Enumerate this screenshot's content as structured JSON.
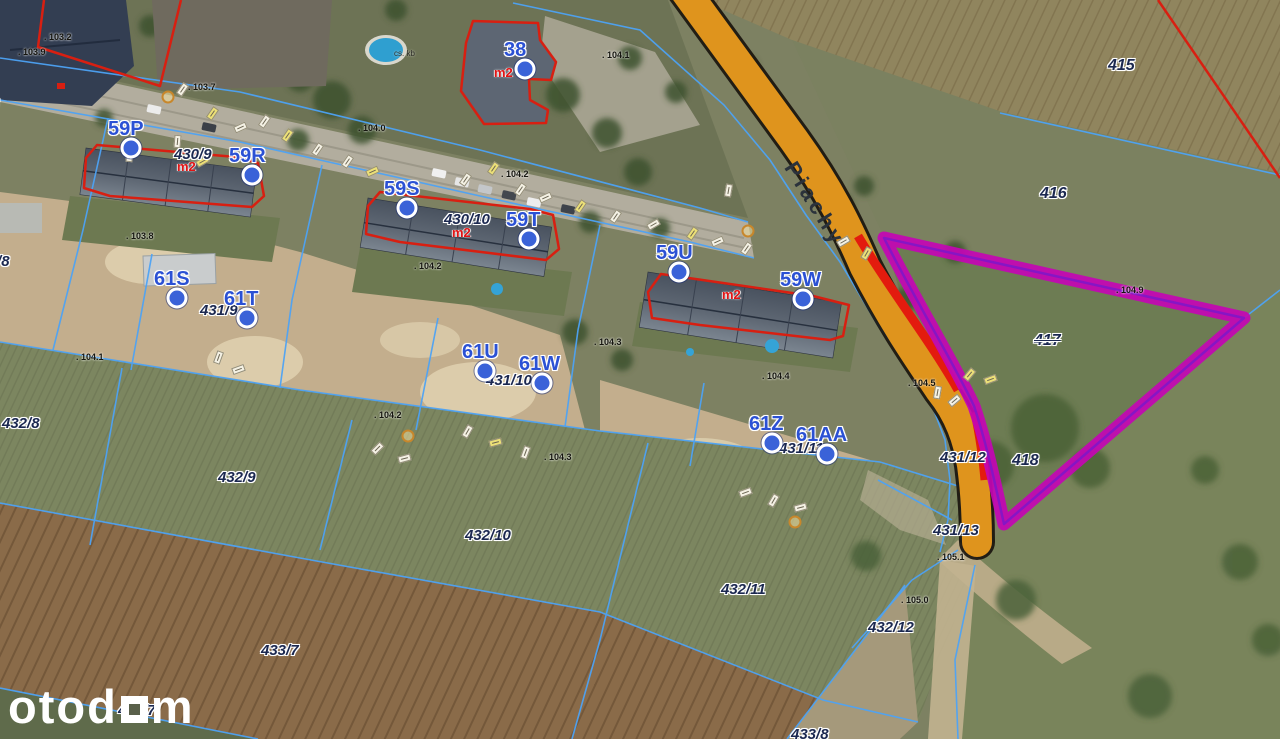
{
  "map": {
    "street": {
      "text": "Piachy",
      "x": 799,
      "y": 158,
      "rot": 58
    },
    "watermark": {
      "prefix": "otod",
      "suffix": "m"
    },
    "tiny_label": {
      "text": "cs. kb",
      "x": 394,
      "y": 50
    },
    "colors": {
      "road": "#df941d",
      "road_red_stripe": "#e31b0e",
      "highlight": "#c405b4",
      "highlight_inner": "#7d18c9",
      "cadastral_line": "#4da3f5",
      "building_outline": "#d81f11",
      "marker_fill": "#3a62d8",
      "marker_text": "#2b51d4",
      "parcel_text": "#1b2850",
      "area_text": "#e21414"
    },
    "parcel_labels": [
      {
        "text": "415",
        "x": 1108,
        "y": 58,
        "big": true
      },
      {
        "text": "416",
        "x": 1040,
        "y": 186,
        "big": true
      },
      {
        "text": "417",
        "x": 1034,
        "y": 333,
        "big": true,
        "struck": true
      },
      {
        "text": "418",
        "x": 1012,
        "y": 453,
        "big": true
      },
      {
        "text": "430/8",
        "x": -38,
        "y": 96
      },
      {
        "text": "430/9",
        "x": 174,
        "y": 147
      },
      {
        "text": "430/10",
        "x": 444,
        "y": 212
      },
      {
        "text": "431/8",
        "x": -28,
        "y": 254
      },
      {
        "text": "431/9",
        "x": 200,
        "y": 303
      },
      {
        "text": "431/10",
        "x": 486,
        "y": 373
      },
      {
        "text": "431/11",
        "x": 779,
        "y": 441
      },
      {
        "text": "431/12",
        "x": 940,
        "y": 450
      },
      {
        "text": "431/13",
        "x": 933,
        "y": 523
      },
      {
        "text": "432/8",
        "x": 2,
        "y": 416
      },
      {
        "text": "432/9",
        "x": 218,
        "y": 470
      },
      {
        "text": "432/10",
        "x": 465,
        "y": 528
      },
      {
        "text": "432/11",
        "x": 721,
        "y": 582
      },
      {
        "text": "432/12",
        "x": 868,
        "y": 620
      },
      {
        "text": "433/7",
        "x": 261,
        "y": 643
      },
      {
        "text": "433/8",
        "x": 791,
        "y": 727
      },
      {
        "text": "434/7",
        "x": 118,
        "y": 703
      }
    ],
    "address_markers": [
      {
        "text": "38",
        "cx": 525,
        "cy": 69,
        "lx": 504,
        "ly": 40
      },
      {
        "text": "59P",
        "cx": 131,
        "cy": 148,
        "lx": 108,
        "ly": 119
      },
      {
        "text": "59R",
        "cx": 252,
        "cy": 175,
        "lx": 229,
        "ly": 146
      },
      {
        "text": "59S",
        "cx": 407,
        "cy": 208,
        "lx": 384,
        "ly": 179
      },
      {
        "text": "59T",
        "cx": 529,
        "cy": 239,
        "lx": 506,
        "ly": 210
      },
      {
        "text": "59U",
        "cx": 679,
        "cy": 272,
        "lx": 656,
        "ly": 243
      },
      {
        "text": "59W",
        "cx": 803,
        "cy": 299,
        "lx": 780,
        "ly": 270
      },
      {
        "text": "61S",
        "cx": 177,
        "cy": 298,
        "lx": 154,
        "ly": 269
      },
      {
        "text": "61T",
        "cx": 247,
        "cy": 318,
        "lx": 224,
        "ly": 289
      },
      {
        "text": "61U",
        "cx": 485,
        "cy": 371,
        "lx": 462,
        "ly": 342
      },
      {
        "text": "61W",
        "cx": 542,
        "cy": 383,
        "lx": 519,
        "ly": 354
      },
      {
        "text": "61Z",
        "cx": 772,
        "cy": 443,
        "lx": 749,
        "ly": 414
      },
      {
        "text": "61AA",
        "cx": 827,
        "cy": 454,
        "lx": 796,
        "ly": 425
      }
    ],
    "area_labels": [
      {
        "text": "m2",
        "x": 494,
        "y": 66
      },
      {
        "text": "m2",
        "x": 177,
        "y": 160
      },
      {
        "text": "m2",
        "x": 452,
        "y": 226
      },
      {
        "text": "m2",
        "x": 722,
        "y": 288
      }
    ],
    "elevation_labels": [
      {
        "text": ". 103.2",
        "x": 44,
        "y": 33
      },
      {
        "text": ". 103.9",
        "x": 18,
        "y": 48
      },
      {
        "text": ". 103.7",
        "x": 188,
        "y": 83
      },
      {
        "text": ". 104.0",
        "x": 358,
        "y": 124
      },
      {
        "text": ". 104.1",
        "x": 602,
        "y": 51
      },
      {
        "text": ". 104.2",
        "x": 501,
        "y": 170
      },
      {
        "text": ". 103.8",
        "x": 126,
        "y": 232
      },
      {
        "text": ". 104.2",
        "x": 414,
        "y": 262
      },
      {
        "text": ". 104.1",
        "x": 76,
        "y": 353
      },
      {
        "text": ". 104.3",
        "x": 594,
        "y": 338
      },
      {
        "text": ". 104.2",
        "x": 374,
        "y": 411
      },
      {
        "text": ". 104.3",
        "x": 544,
        "y": 453
      },
      {
        "text": ". 104.4",
        "x": 762,
        "y": 372
      },
      {
        "text": ". 104.5",
        "x": 908,
        "y": 379
      },
      {
        "text": ". 104.9",
        "x": 1116,
        "y": 286
      },
      {
        "text": ". 105.1",
        "x": 937,
        "y": 553
      },
      {
        "text": ". 105.0",
        "x": 901,
        "y": 596
      }
    ],
    "survey_marks": [
      {
        "x": 176,
        "y": 86,
        "r": -55,
        "c": "w"
      },
      {
        "x": 206,
        "y": 110,
        "r": -55,
        "c": "y"
      },
      {
        "x": 234,
        "y": 124,
        "r": -25,
        "c": "w"
      },
      {
        "x": 258,
        "y": 118,
        "r": -55,
        "c": "w"
      },
      {
        "x": 281,
        "y": 132,
        "r": -55,
        "c": "y"
      },
      {
        "x": 171,
        "y": 138,
        "r": -85,
        "c": "w"
      },
      {
        "x": 123,
        "y": 152,
        "r": -85,
        "c": "w"
      },
      {
        "x": 196,
        "y": 158,
        "r": -30,
        "c": "y"
      },
      {
        "x": 311,
        "y": 146,
        "r": -55,
        "c": "w"
      },
      {
        "x": 341,
        "y": 158,
        "r": -55,
        "c": "w"
      },
      {
        "x": 366,
        "y": 168,
        "r": -25,
        "c": "y"
      },
      {
        "x": 459,
        "y": 176,
        "r": -55,
        "c": "w"
      },
      {
        "x": 487,
        "y": 165,
        "r": -55,
        "c": "y"
      },
      {
        "x": 514,
        "y": 186,
        "r": -55,
        "c": "w"
      },
      {
        "x": 539,
        "y": 194,
        "r": -25,
        "c": "w"
      },
      {
        "x": 574,
        "y": 203,
        "r": -55,
        "c": "y"
      },
      {
        "x": 609,
        "y": 213,
        "r": -55,
        "c": "w"
      },
      {
        "x": 647,
        "y": 221,
        "r": -30,
        "c": "w"
      },
      {
        "x": 686,
        "y": 230,
        "r": -55,
        "c": "y"
      },
      {
        "x": 711,
        "y": 238,
        "r": -25,
        "c": "w"
      },
      {
        "x": 740,
        "y": 245,
        "r": -55,
        "c": "w"
      },
      {
        "x": 722,
        "y": 187,
        "r": -80,
        "c": "w"
      },
      {
        "x": 212,
        "y": 354,
        "r": -70,
        "c": "w"
      },
      {
        "x": 232,
        "y": 366,
        "r": -20,
        "c": "w"
      },
      {
        "x": 461,
        "y": 428,
        "r": -60,
        "c": "w"
      },
      {
        "x": 489,
        "y": 439,
        "r": -15,
        "c": "y"
      },
      {
        "x": 519,
        "y": 449,
        "r": -70,
        "c": "w"
      },
      {
        "x": 739,
        "y": 489,
        "r": -20,
        "c": "w"
      },
      {
        "x": 767,
        "y": 497,
        "r": -60,
        "c": "w"
      },
      {
        "x": 794,
        "y": 504,
        "r": -15,
        "c": "w"
      },
      {
        "x": 931,
        "y": 389,
        "r": -80,
        "c": "w"
      },
      {
        "x": 948,
        "y": 397,
        "r": -40,
        "c": "w"
      },
      {
        "x": 837,
        "y": 238,
        "r": -30,
        "c": "w"
      },
      {
        "x": 860,
        "y": 250,
        "r": -60,
        "c": "y"
      },
      {
        "x": 963,
        "y": 371,
        "r": -50,
        "c": "y"
      },
      {
        "x": 984,
        "y": 376,
        "r": -20,
        "c": "y"
      },
      {
        "x": 371,
        "y": 445,
        "r": -45,
        "c": "w"
      },
      {
        "x": 398,
        "y": 455,
        "r": -15,
        "c": "w"
      }
    ],
    "survey_points": [
      {
        "x": 168,
        "y": 97
      },
      {
        "x": 748,
        "y": 231
      },
      {
        "x": 408,
        "y": 436
      },
      {
        "x": 795,
        "y": 522
      }
    ]
  }
}
